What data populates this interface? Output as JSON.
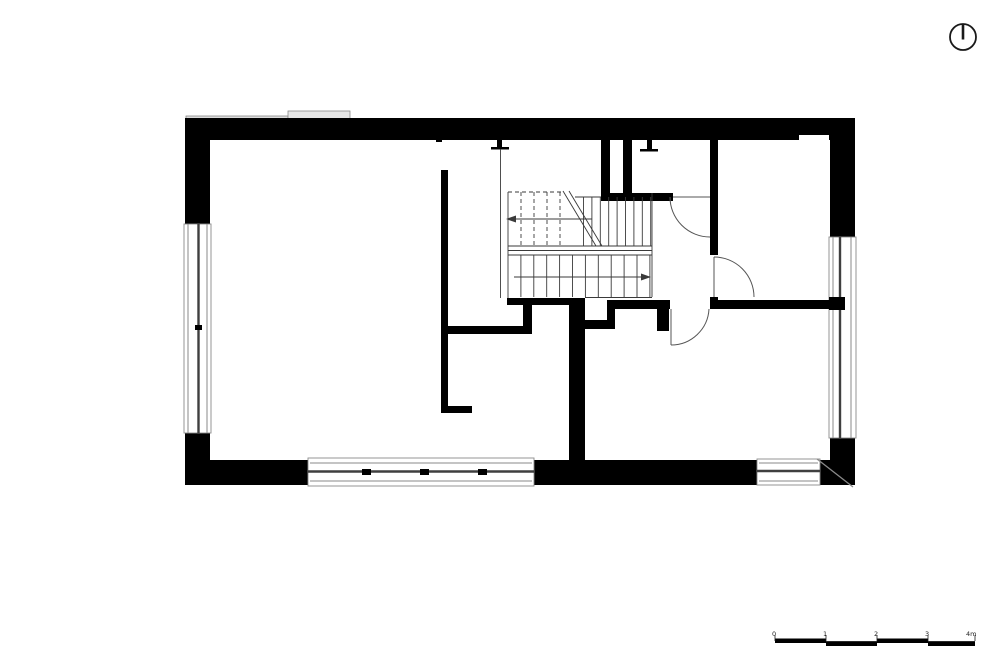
{
  "document": {
    "type": "architectural-floor-plan",
    "background": "#ffffff"
  },
  "colors": {
    "wall": "#000000",
    "thin_line": "#3a3a3a",
    "frame_line": "#8a8a8a",
    "glass_line": "#3f3f3f",
    "canopy_fill_left": "#dcdcdc",
    "canopy_fill_right": "#e6e6e6"
  },
  "north_indicator": {
    "shape": "circle-with-vertical-needle"
  },
  "scale_bar": {
    "labels": [
      "0",
      "1",
      "2",
      "3",
      "4m"
    ]
  }
}
